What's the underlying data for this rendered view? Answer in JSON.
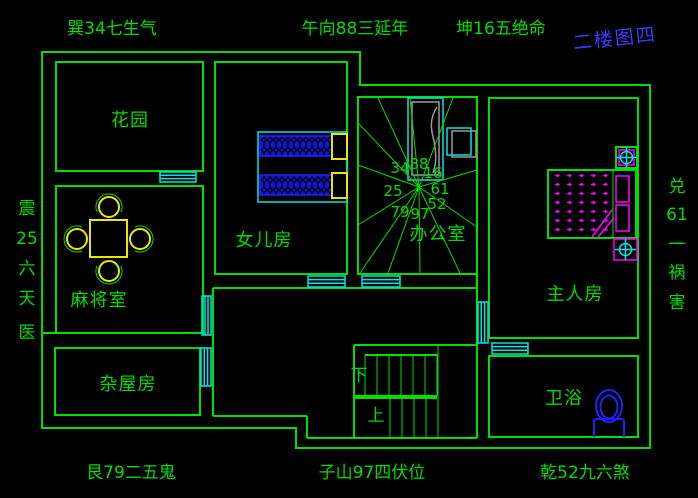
{
  "drawing": {
    "title": "二楼图四",
    "compass": {
      "top_left": "巽34七生气",
      "top_center": "午向88三延年",
      "top_right": "坤16五绝命",
      "bottom_left": "艮79二五鬼",
      "bottom_center": "子山97四伏位",
      "bottom_right": "乾52九六煞",
      "left_vertical": [
        "震",
        "25",
        "六",
        "天",
        "医"
      ],
      "right_vertical": [
        "兑",
        "61",
        "一",
        "祸",
        "害"
      ]
    },
    "rooms": {
      "garden": "花园",
      "mahjong": "麻将室",
      "storage": "杂屋房",
      "daughter": "女儿房",
      "office": "办公室",
      "master": "主人房",
      "bath": "卫浴"
    },
    "stairs": {
      "down": "下",
      "up": "上"
    },
    "star_numbers": {
      "nw": "34",
      "n": "88",
      "ne": "16",
      "w": "25",
      "e": "61",
      "sw": "79",
      "s": "97",
      "se": "52"
    },
    "colors": {
      "background": "#000000",
      "line_green": "#00dd00",
      "window_cyan": "#00e5e5",
      "furniture_yellow": "#e8e800",
      "furniture_magenta": "#ff00ff",
      "furniture_blue": "#2020ff",
      "title_blue": "#3a3aff",
      "desk_gray": "#9a9a9a"
    }
  }
}
